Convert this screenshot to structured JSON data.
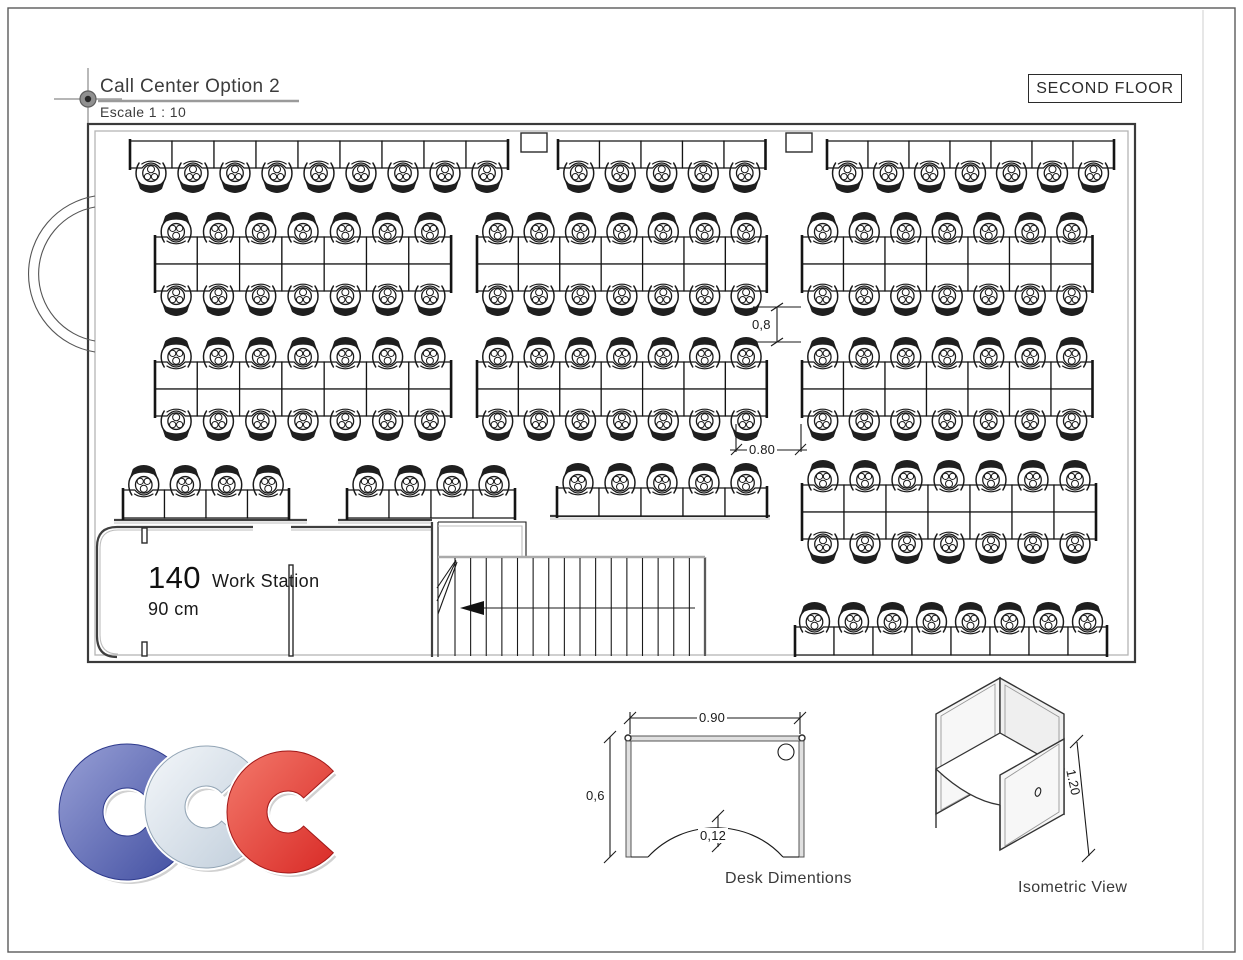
{
  "title_block": {
    "title": "Call Center Option 2",
    "scale_label": "Escale 1 : 10"
  },
  "floor_label": "SECOND FLOOR",
  "room_label": {
    "count": "140",
    "unit": "Work Station",
    "size": "90 cm"
  },
  "dimensions": {
    "aisle_vertical": "0,8",
    "aisle_horizontal": "0.80"
  },
  "desk_diagram": {
    "width": "0.90",
    "depth": "0,6",
    "cutout": "0,12",
    "caption": "Desk Dimentions"
  },
  "isometric": {
    "height": "1.20",
    "caption": "Isometric View"
  },
  "logo": {
    "letters": [
      "C",
      "C",
      "C"
    ],
    "colors": {
      "blue": "#4350a2",
      "silver": "#c2cfdc",
      "red": "#d92b27"
    }
  },
  "floorplan": {
    "total_workstations": 140,
    "wall_rows": [
      {
        "name": "top-row-left",
        "x": 130,
        "y": 141,
        "n": 9,
        "w": 42.0,
        "h": 27,
        "chair": "below"
      },
      {
        "name": "top-row-mid",
        "x": 558,
        "y": 141,
        "n": 5,
        "w": 41.5,
        "h": 27,
        "chair": "below"
      },
      {
        "name": "top-row-right",
        "x": 827,
        "y": 141,
        "n": 7,
        "w": 41.0,
        "h": 27,
        "chair": "below"
      },
      {
        "name": "lower-left-a",
        "x": 123,
        "y": 490,
        "n": 4,
        "w": 41.5,
        "h": 28,
        "chair": "above"
      },
      {
        "name": "lower-left-b",
        "x": 347,
        "y": 490,
        "n": 4,
        "w": 42.0,
        "h": 28,
        "chair": "above"
      },
      {
        "name": "lower-mid",
        "x": 557,
        "y": 488,
        "n": 5,
        "w": 42.0,
        "h": 28,
        "chair": "above"
      },
      {
        "name": "bottom-right-row",
        "x": 795,
        "y": 627,
        "n": 8,
        "w": 39.0,
        "h": 28,
        "chair": "above"
      }
    ],
    "double_banks": [
      {
        "name": "band1-left",
        "x": 155,
        "y": 237,
        "n": 7,
        "w": 42.3,
        "rowH": 27
      },
      {
        "name": "band1-mid",
        "x": 477,
        "y": 237,
        "n": 7,
        "w": 41.4,
        "rowH": 27
      },
      {
        "name": "band1-right",
        "x": 802,
        "y": 237,
        "n": 7,
        "w": 41.5,
        "rowH": 27
      },
      {
        "name": "band2-left",
        "x": 155,
        "y": 362,
        "n": 7,
        "w": 42.3,
        "rowH": 27
      },
      {
        "name": "band2-mid",
        "x": 477,
        "y": 362,
        "n": 7,
        "w": 41.4,
        "rowH": 27
      },
      {
        "name": "band2-right",
        "x": 802,
        "y": 362,
        "n": 7,
        "w": 41.5,
        "rowH": 27
      },
      {
        "name": "bottom-right-bank",
        "x": 802,
        "y": 485,
        "n": 7,
        "w": 42.0,
        "rowH": 27
      }
    ]
  }
}
